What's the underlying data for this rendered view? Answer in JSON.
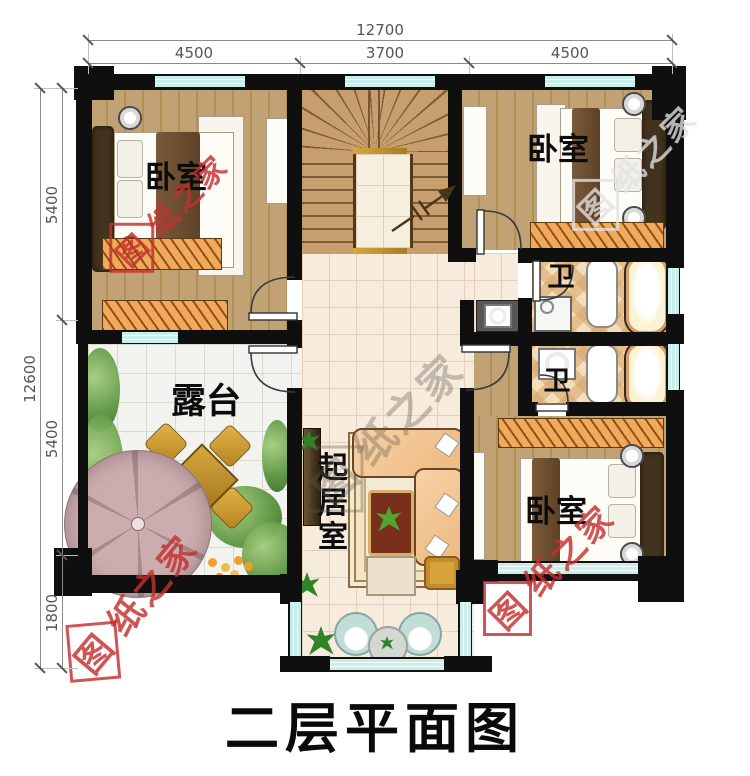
{
  "title": "二层平面图",
  "watermark": {
    "first": "图",
    "rest": "纸之家"
  },
  "dimensions": {
    "top": {
      "total": "12700",
      "segments": [
        "4500",
        "3700",
        "4500"
      ]
    },
    "left": {
      "total": "12600",
      "segments": [
        "5400",
        "5400",
        "1800"
      ]
    }
  },
  "rooms": {
    "bedroom": "卧室",
    "bath": "卫",
    "terrace": "露台",
    "living": "起居室"
  },
  "colors": {
    "wall": "#0f0f0f",
    "window": "#c6efec",
    "wood_floor": "#bfa173",
    "stair_wood": "#c79e6e",
    "hall_tile": "#f7ebdd",
    "terrace_tile": "#f2f2ee",
    "bath_tile": "#f4ddba",
    "wardrobe": "#f4a859",
    "watermark_red": "#c53030"
  }
}
